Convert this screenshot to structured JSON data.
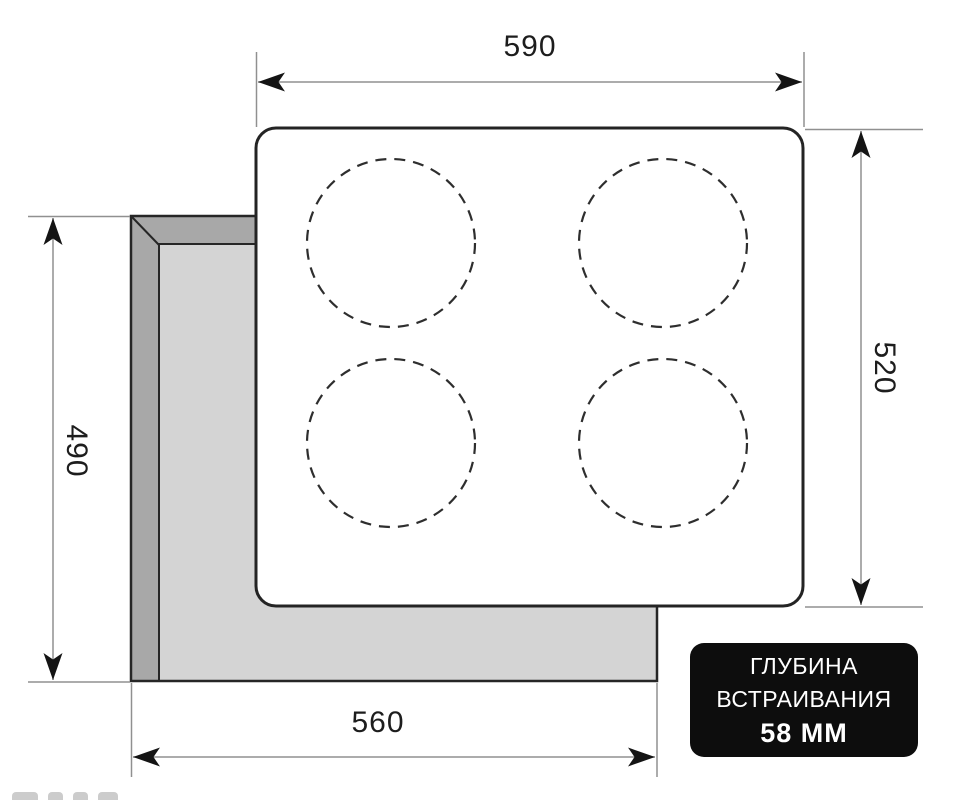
{
  "diagram_type": "cooktop-installation-dimensions",
  "dimensions": {
    "top": "590",
    "right": "520",
    "left": "490",
    "bottom": "560"
  },
  "badge": {
    "line1": "ГЛУБИНА",
    "line2": "ВСТРАИВАНИЯ",
    "line3": "58 ММ"
  },
  "burner_zones": 4,
  "colors": {
    "panel_fill": "#ffffff",
    "outline": "#262626",
    "cutout_band": "#a8a8a8",
    "cutout_inner": "#d4d4d4",
    "dimension_line": "#909090",
    "arrowhead": "#141414",
    "label_text": "#1d1d1d",
    "badge_bg": "#0d0d0d",
    "badge_text": "#ffffff"
  }
}
